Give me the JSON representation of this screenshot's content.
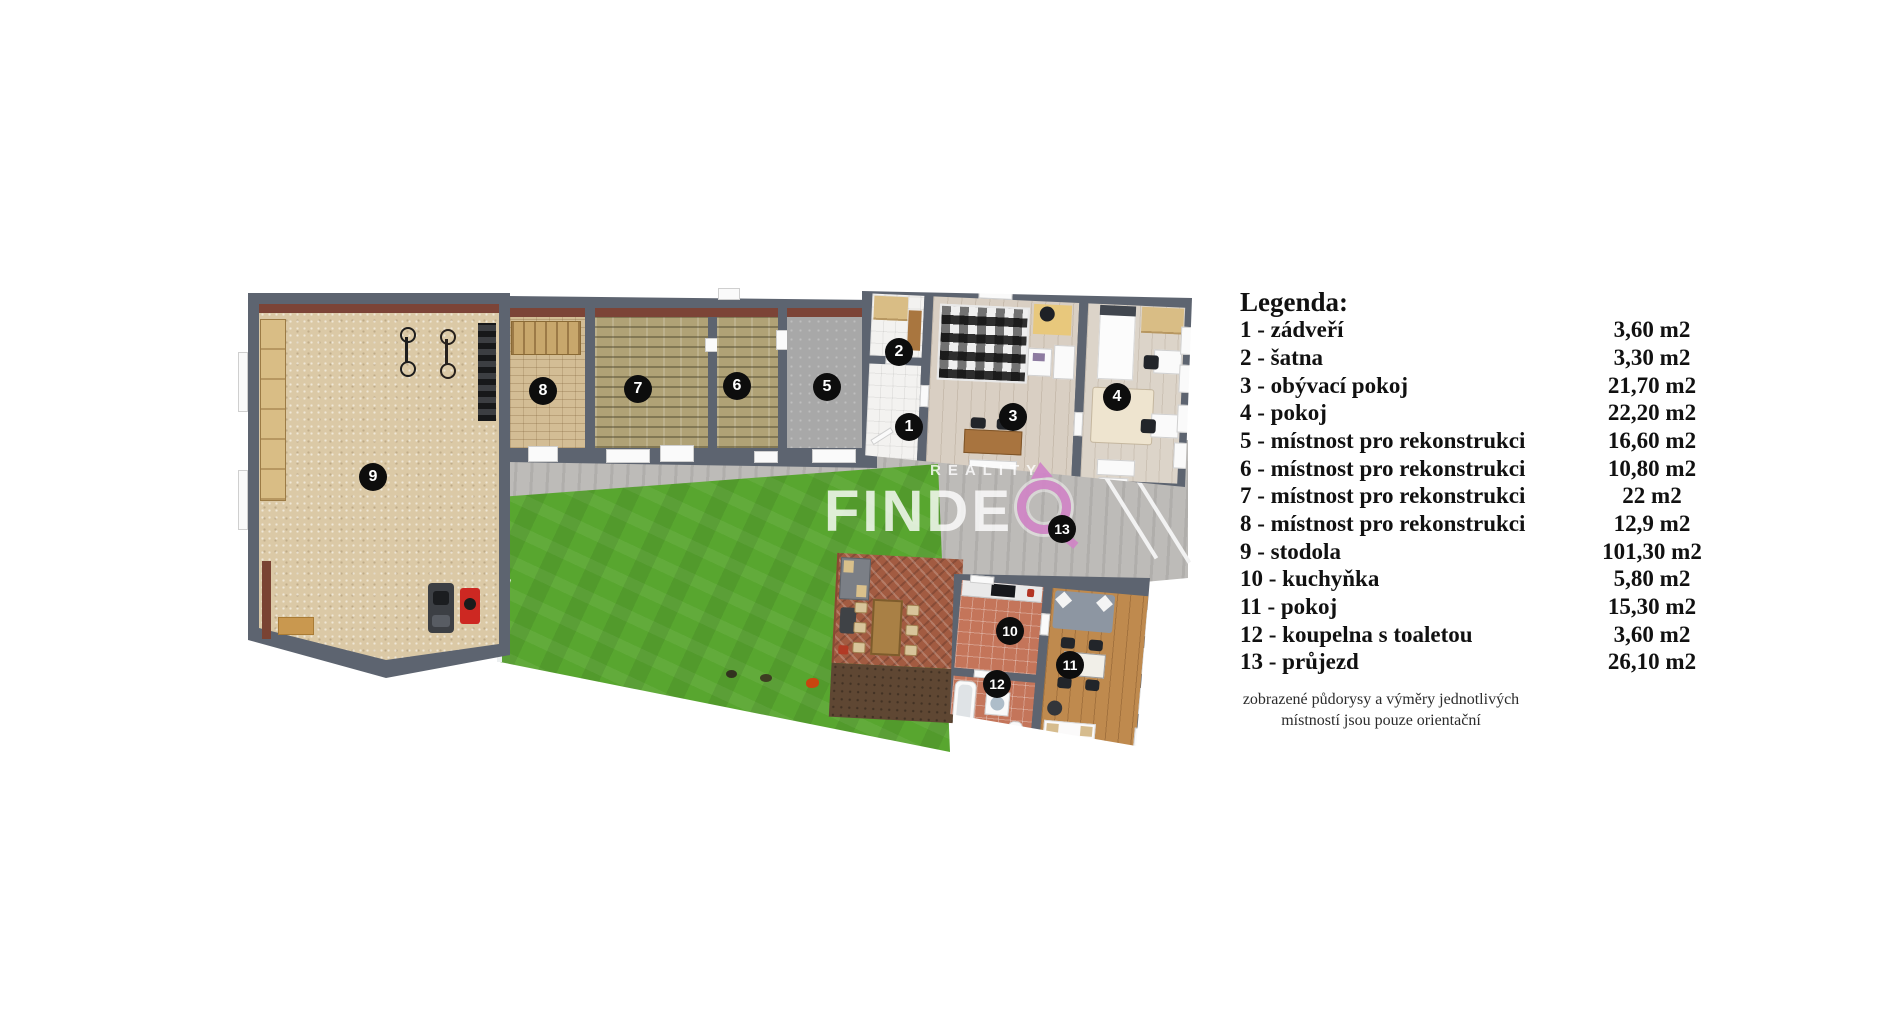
{
  "colors": {
    "wall": "#5d6470",
    "interior_band": "#7c4437",
    "grass": "#58a62f",
    "accent_magenta": "#cf82c6",
    "terracotta": "#c4755a",
    "paving": "#bdbbb8"
  },
  "watermark": {
    "top": "REALITY",
    "main": "FINDE",
    "o_symbol_name": "magenta-ring-compass"
  },
  "badges": [
    "1",
    "2",
    "3",
    "4",
    "5",
    "6",
    "7",
    "8",
    "9",
    "10",
    "11",
    "12",
    "13"
  ],
  "legend": {
    "title": "Legenda:",
    "rows": [
      {
        "label": "1 - zádveří",
        "area": "3,60 m2"
      },
      {
        "label": "2 - šatna",
        "area": "3,30 m2"
      },
      {
        "label": "3 - obývací pokoj",
        "area": "21,70 m2"
      },
      {
        "label": "4 - pokoj",
        "area": "22,20 m2"
      },
      {
        "label": "5 - místnost pro rekonstrukci",
        "area": "16,60 m2"
      },
      {
        "label": "6 - místnost pro rekonstrukci",
        "area": "10,80 m2"
      },
      {
        "label": "7 - místnost pro rekonstrukci",
        "area": "22 m2"
      },
      {
        "label": "8 - místnost pro rekonstrukci",
        "area": "12,9 m2"
      },
      {
        "label": "9 - stodola",
        "area": "101,30 m2"
      },
      {
        "label": "10 - kuchyňka",
        "area": "5,80 m2"
      },
      {
        "label": "11 - pokoj",
        "area": "15,30 m2"
      },
      {
        "label": "12 - koupelna s toaletou",
        "area": "3,60 m2"
      },
      {
        "label": "13 - průjezd",
        "area": "26,10 m2"
      }
    ],
    "note1": "zobrazené půdorysy a výměry jednotlivých",
    "note2": "místností jsou pouze orientační"
  }
}
